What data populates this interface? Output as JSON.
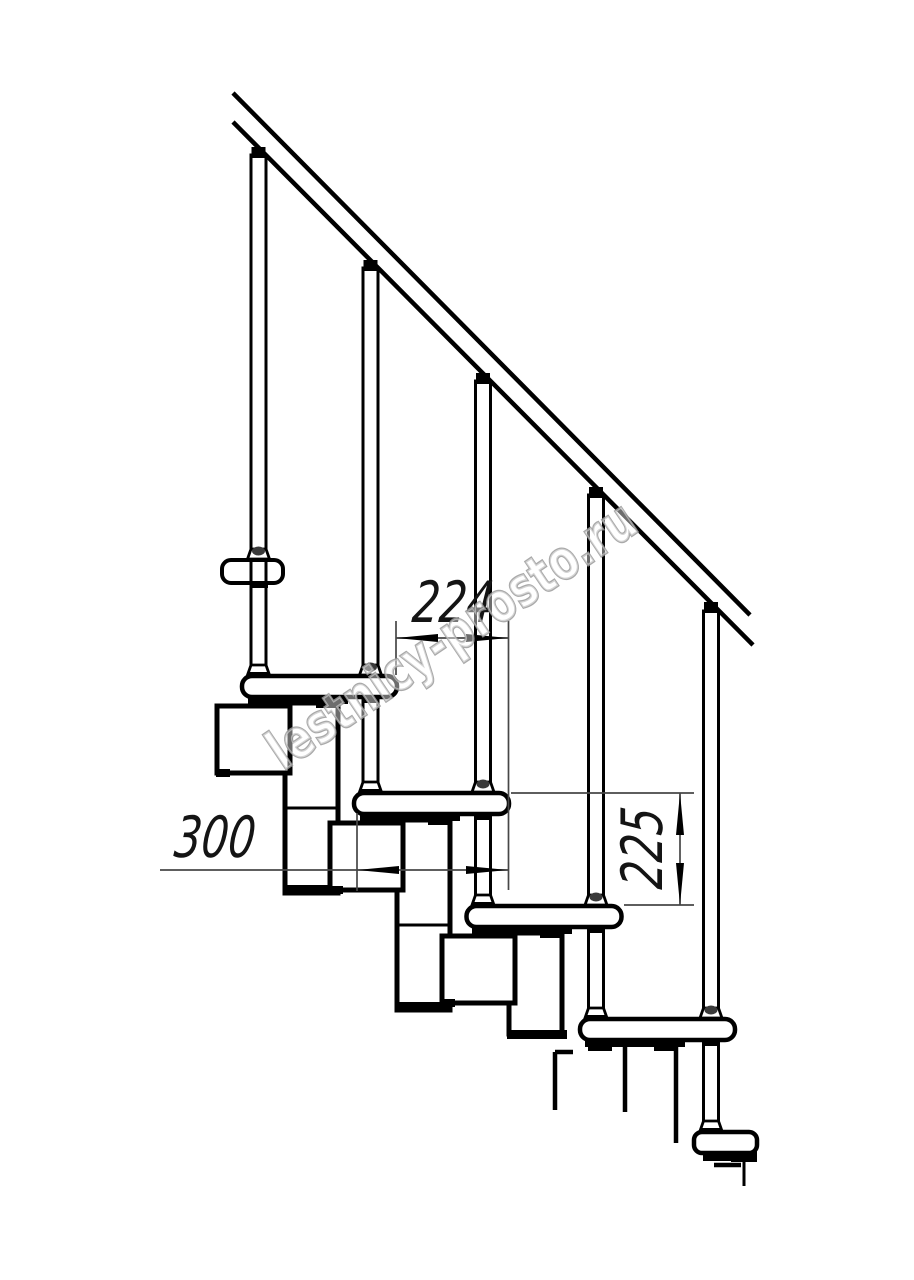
{
  "canvas": {
    "width": 914,
    "height": 1280,
    "background": "#ffffff",
    "line_color": "#000000",
    "dimension_line_color": "#474747",
    "watermark_color": "#9b9b9b"
  },
  "drawing": {
    "kind": "staircase-side-view-technical-drawing",
    "treads_visible": 5,
    "balusters_visible": 5,
    "handrail": "diagonal double line, top-left to mid-right"
  },
  "dimensions": {
    "d224": {
      "value": "224",
      "orientation": "horizontal",
      "measures": "step run between tread noses"
    },
    "d300": {
      "value": "300",
      "orientation": "horizontal",
      "measures": "tread length"
    },
    "d225": {
      "value": "225",
      "orientation": "vertical",
      "measures": "step rise"
    }
  },
  "watermark": {
    "text": "lestnicy-prosto.ru"
  }
}
